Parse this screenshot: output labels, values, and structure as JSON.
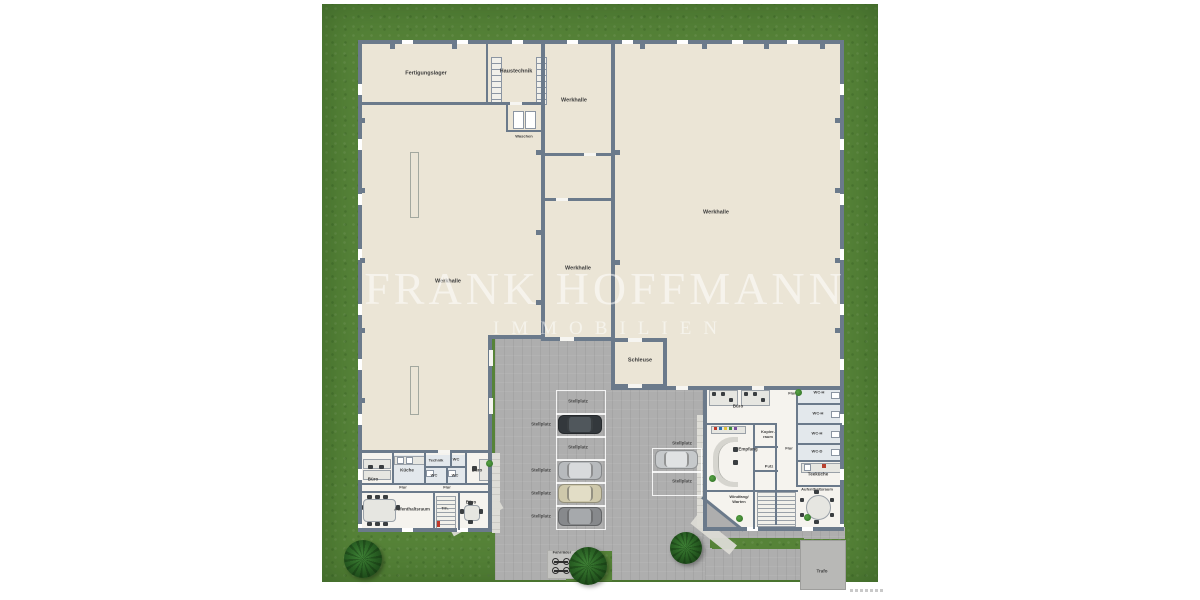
{
  "watermark": {
    "line1": "FRANK HOFFMANN",
    "line2": "IMMOBILIEN"
  },
  "colors": {
    "grass": "#568338",
    "pavement": "#aeaeae",
    "wall": "#6b7a8b",
    "hall_floor": "#ebe5d6",
    "office_floor": "#f5f3ee",
    "tile_floor": "#e3e8ec",
    "label": "#3c3c3c",
    "tree": "#2b6425"
  },
  "plan": {
    "labels": [
      {
        "text": "Fertigungslager",
        "x": 426,
        "y": 74,
        "cls": "hall"
      },
      {
        "text": "Haustechnik",
        "x": 516,
        "y": 72,
        "cls": "hall"
      },
      {
        "text": "Waschen",
        "x": 524,
        "y": 137,
        "cls": "tiny"
      },
      {
        "text": "Werkhalle",
        "x": 574,
        "y": 101,
        "cls": "hall"
      },
      {
        "text": "Werkhalle",
        "x": 448,
        "y": 282,
        "cls": "hall"
      },
      {
        "text": "Werkhalle",
        "x": 578,
        "y": 269,
        "cls": "hall"
      },
      {
        "text": "Werkhalle",
        "x": 716,
        "y": 213,
        "cls": "hall"
      },
      {
        "text": "Schleuse",
        "x": 640,
        "y": 361,
        "cls": "hall"
      },
      {
        "text": "Büro",
        "x": 373,
        "y": 479,
        "cls": ""
      },
      {
        "text": "Küche",
        "x": 407,
        "y": 470,
        "cls": ""
      },
      {
        "text": "Technik",
        "x": 436,
        "y": 461,
        "cls": "tiny"
      },
      {
        "text": "WC",
        "x": 456,
        "y": 460,
        "cls": "tiny"
      },
      {
        "text": "WC",
        "x": 434,
        "y": 476,
        "cls": "tiny"
      },
      {
        "text": "WC",
        "x": 455,
        "y": 476,
        "cls": "tiny"
      },
      {
        "text": "Flur",
        "x": 403,
        "y": 488,
        "cls": "tiny"
      },
      {
        "text": "Flur",
        "x": 447,
        "y": 488,
        "cls": "tiny"
      },
      {
        "text": "Büro",
        "x": 477,
        "y": 470,
        "cls": ""
      },
      {
        "text": "Aufenthaltsraum",
        "x": 412,
        "y": 509,
        "cls": ""
      },
      {
        "text": "Trh.",
        "x": 445,
        "y": 509,
        "cls": "tiny"
      },
      {
        "text": "Büro",
        "x": 471,
        "y": 502,
        "cls": ""
      },
      {
        "text": "Büro",
        "x": 738,
        "y": 406,
        "cls": ""
      },
      {
        "text": "Flur",
        "x": 792,
        "y": 394,
        "cls": "tiny"
      },
      {
        "text": "WC-H",
        "x": 819,
        "y": 393,
        "cls": "tiny"
      },
      {
        "text": "WC-H",
        "x": 818,
        "y": 414,
        "cls": "tiny"
      },
      {
        "text": "WC-H",
        "x": 817,
        "y": 434,
        "cls": "tiny"
      },
      {
        "text": "WC-D",
        "x": 817,
        "y": 452,
        "cls": "tiny"
      },
      {
        "text": "Empfang",
        "x": 748,
        "y": 449,
        "cls": ""
      },
      {
        "text": "Kopier-\nraum",
        "x": 768,
        "y": 435,
        "cls": "tiny"
      },
      {
        "text": "Flur",
        "x": 789,
        "y": 449,
        "cls": "tiny"
      },
      {
        "text": "Putz",
        "x": 769,
        "y": 467,
        "cls": "tiny"
      },
      {
        "text": "Teeküche",
        "x": 818,
        "y": 474,
        "cls": ""
      },
      {
        "text": "Aufenthaltsraum",
        "x": 817,
        "y": 490,
        "cls": "tiny"
      },
      {
        "text": "Windfang/\nWarten",
        "x": 739,
        "y": 500,
        "cls": "tiny"
      },
      {
        "text": "Trafo",
        "x": 822,
        "y": 571,
        "cls": ""
      },
      {
        "text": "Fahrräder",
        "x": 562,
        "y": 553,
        "cls": "tiny"
      },
      {
        "text": "Stellplatz",
        "x": 578,
        "y": 401,
        "cls": "spot-l"
      },
      {
        "text": "Stellplatz",
        "x": 541,
        "y": 424,
        "cls": "spot-l"
      },
      {
        "text": "Stellplatz",
        "x": 578,
        "y": 447,
        "cls": "spot-l"
      },
      {
        "text": "Stellplatz",
        "x": 541,
        "y": 470,
        "cls": "spot-l"
      },
      {
        "text": "Stellplatz",
        "x": 541,
        "y": 493,
        "cls": "spot-l"
      },
      {
        "text": "Stellplatz",
        "x": 541,
        "y": 516,
        "cls": "spot-l"
      },
      {
        "text": "Stellplatz",
        "x": 682,
        "y": 443,
        "cls": "spot-l"
      },
      {
        "text": "Stellplatz",
        "x": 682,
        "y": 481,
        "cls": "spot-l"
      }
    ],
    "parking": {
      "spots": [
        {
          "x": 556,
          "y": 390,
          "w": 48,
          "h": 23
        },
        {
          "x": 556,
          "y": 413,
          "w": 48,
          "h": 23
        },
        {
          "x": 556,
          "y": 436,
          "w": 48,
          "h": 23
        },
        {
          "x": 556,
          "y": 459,
          "w": 48,
          "h": 23
        },
        {
          "x": 556,
          "y": 482,
          "w": 48,
          "h": 23
        },
        {
          "x": 556,
          "y": 505,
          "w": 48,
          "h": 23
        },
        {
          "x": 652,
          "y": 448,
          "w": 48,
          "h": 23
        },
        {
          "x": 652,
          "y": 471,
          "w": 48,
          "h": 23
        }
      ],
      "cars": [
        {
          "x": 558,
          "y": 415,
          "w": 44,
          "h": 19,
          "body": "#33383c",
          "roof": "#50575c"
        },
        {
          "x": 558,
          "y": 461,
          "w": 44,
          "h": 19,
          "body": "#b7babd",
          "roof": "#d8dadc"
        },
        {
          "x": 558,
          "y": 484,
          "w": 44,
          "h": 19,
          "body": "#cec8ab",
          "roof": "#e2ddc6"
        },
        {
          "x": 558,
          "y": 507,
          "w": 44,
          "h": 19,
          "body": "#87898c",
          "roof": "#a6a9ac"
        },
        {
          "x": 655,
          "y": 450,
          "w": 43,
          "h": 19,
          "body": "#c6c9cb",
          "roof": "#e0e2e3"
        }
      ]
    },
    "trees": [
      {
        "x": 363,
        "y": 559,
        "r": 19
      },
      {
        "x": 588,
        "y": 566,
        "r": 19
      },
      {
        "x": 686,
        "y": 548,
        "r": 16
      }
    ],
    "plants": [
      {
        "x": 489,
        "y": 463
      },
      {
        "x": 798,
        "y": 392
      },
      {
        "x": 712,
        "y": 478
      },
      {
        "x": 739,
        "y": 518
      },
      {
        "x": 807,
        "y": 517
      }
    ],
    "pilasters": [
      {
        "x": 390,
        "y": 44
      },
      {
        "x": 452,
        "y": 44
      },
      {
        "x": 640,
        "y": 44
      },
      {
        "x": 702,
        "y": 44
      },
      {
        "x": 764,
        "y": 44
      },
      {
        "x": 820,
        "y": 44
      },
      {
        "x": 360,
        "y": 118
      },
      {
        "x": 360,
        "y": 188
      },
      {
        "x": 360,
        "y": 258
      },
      {
        "x": 360,
        "y": 328
      },
      {
        "x": 360,
        "y": 398
      },
      {
        "x": 835,
        "y": 118
      },
      {
        "x": 835,
        "y": 188
      },
      {
        "x": 835,
        "y": 258
      },
      {
        "x": 835,
        "y": 328
      },
      {
        "x": 615,
        "y": 150
      },
      {
        "x": 615,
        "y": 260
      },
      {
        "x": 536,
        "y": 150
      },
      {
        "x": 536,
        "y": 230
      },
      {
        "x": 536,
        "y": 300
      }
    ]
  }
}
